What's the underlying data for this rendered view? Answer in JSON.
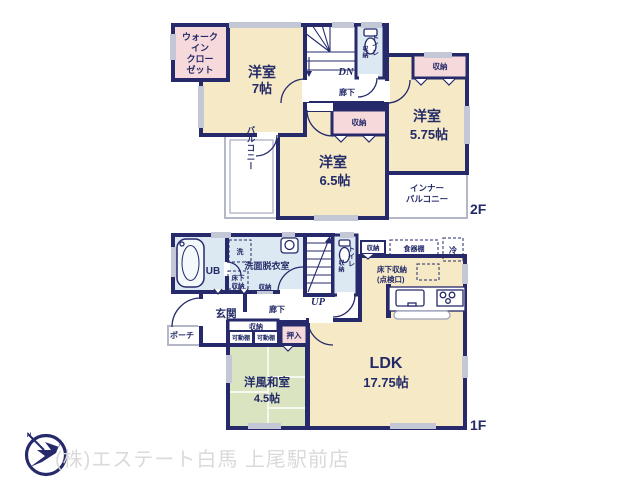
{
  "colors": {
    "wall_navy": "#262a6b",
    "text_navy": "#232a68",
    "room_beige": "#f6e9c5",
    "closet_pink": "#f6d9da",
    "wet_area_blue": "#dde9f2",
    "tatami_green": "#dae4c1",
    "window_gray": "#c4c8d6",
    "outdoor_line_gray": "#b3b7c6",
    "footer_text_gray": "#dadada"
  },
  "floor2": {
    "floor_tag": "2F",
    "walk_in_closet_lines": [
      "ウォーク",
      "イン",
      "クロー",
      "ゼット"
    ],
    "room7": {
      "name": "洋室",
      "size": "7帖"
    },
    "room65": {
      "name": "洋室",
      "size": "6.5帖"
    },
    "room575": {
      "name": "洋室",
      "size": "5.75帖"
    },
    "closet": "収納",
    "toilet": "トイレ",
    "hallway": "廊下",
    "stairs_down": "DN",
    "balcony": "バルコニー",
    "inner_balcony_lines": [
      "インナー",
      "バルコニー"
    ]
  },
  "floor1": {
    "floor_tag": "1F",
    "unit_bath": "UB",
    "washer": "洗",
    "washroom": "洗面脱衣室",
    "underfloor_small_lines": [
      "床下",
      "収納"
    ],
    "closet": "収納",
    "entrance": "玄関",
    "porch": "ポーチ",
    "hallway": "廊下",
    "stairs_up": "UP",
    "toilet": "トイレ",
    "cupboard": "食器棚",
    "fridge": "冷",
    "underfloor_lines": [
      "床下収納",
      "(点検口)"
    ],
    "ldk": {
      "name": "LDK",
      "size": "17.75帖"
    },
    "movable_shelf": "可動棚",
    "oshiire": "押入",
    "washitsu": {
      "name": "洋風和室",
      "size": "4.5帖"
    }
  },
  "footer": {
    "company": "(株)エステート白馬 上尾駅前店"
  }
}
